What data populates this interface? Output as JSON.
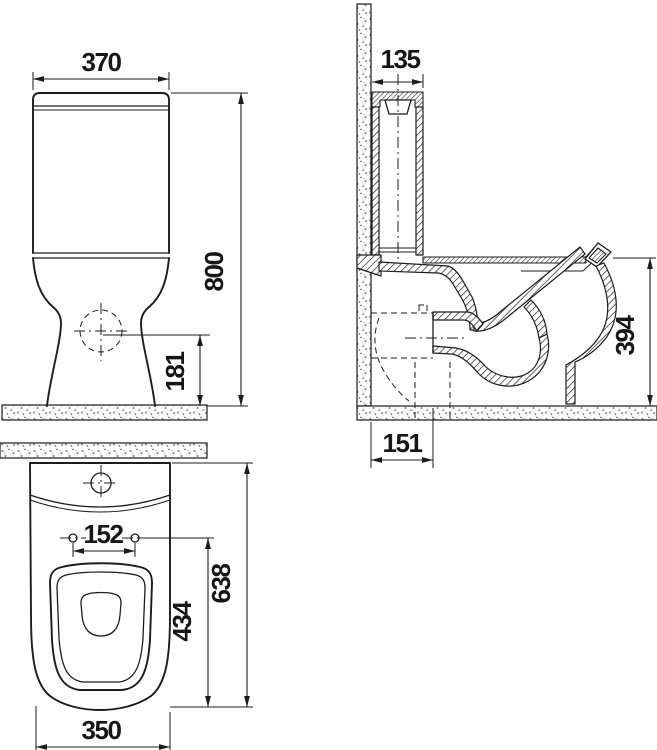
{
  "drawing": {
    "background": "#ffffff",
    "line_color": "#1c1c1c",
    "views": {
      "front": {
        "dims": {
          "overall_width": "370",
          "overall_height": "800",
          "outlet_height": "181"
        }
      },
      "side": {
        "dims": {
          "cistern_depth": "135",
          "bowl_height": "394",
          "outlet_offset": "151"
        }
      },
      "plan": {
        "dims": {
          "hole_spacing": "152",
          "hole_to_front": "434",
          "overall_depth": "638",
          "front_width": "350"
        }
      }
    }
  }
}
